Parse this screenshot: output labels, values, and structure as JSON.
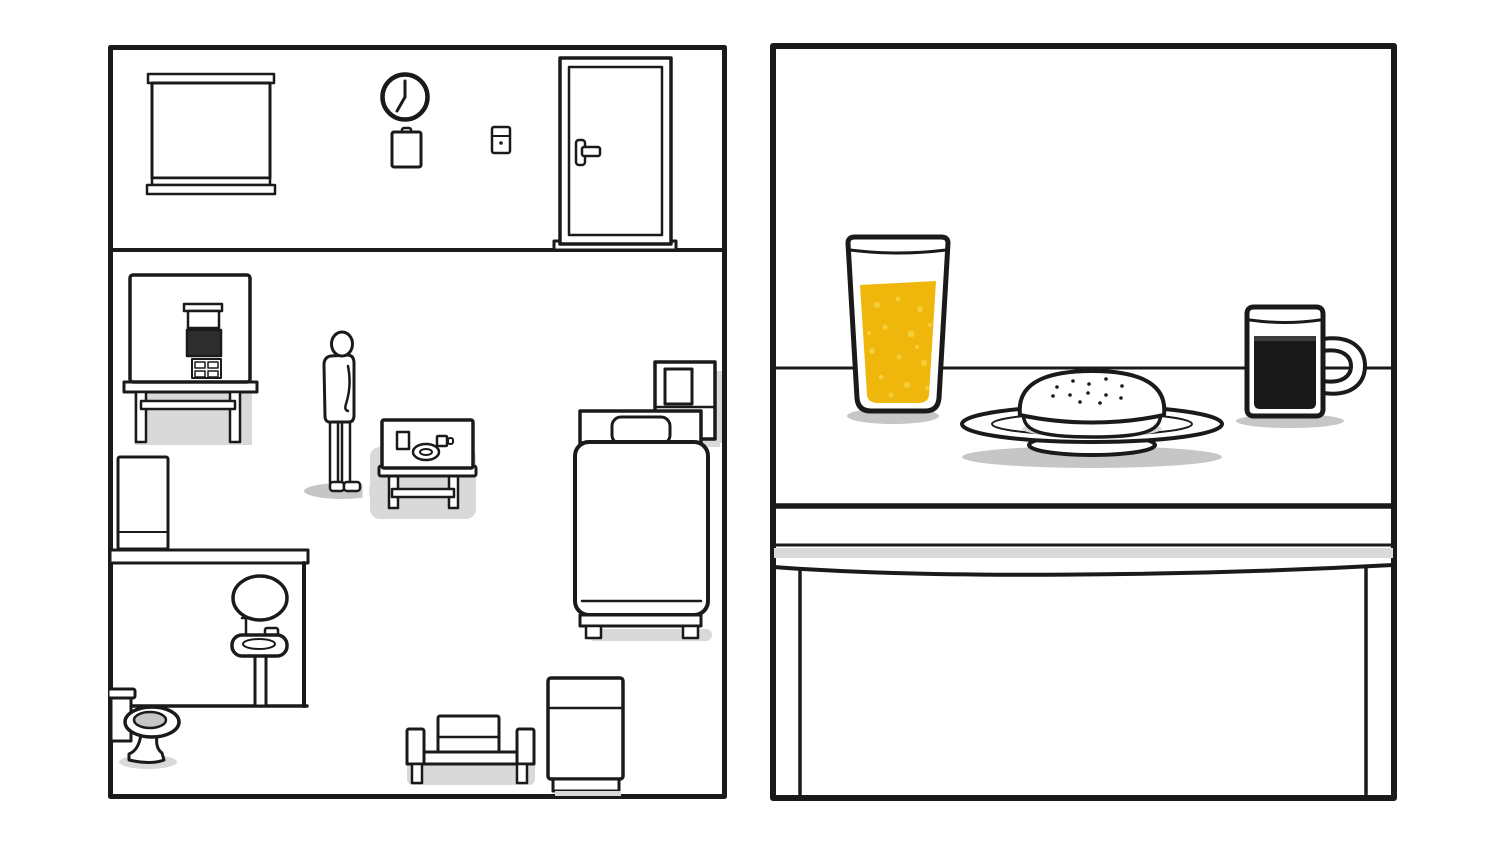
{
  "scene": {
    "game_style": "white-door-room",
    "text_content": "none"
  },
  "colors": {
    "background": "#ffffff",
    "line": "#1a1a1a",
    "juice": "#efb70b",
    "juice_bubble": "#f6ce3a",
    "coffee": "#191919",
    "coffee_surface": "#3c3c3c",
    "shadow": "#c6c6c6",
    "shadow_light": "#d9d9d9",
    "gray_strip": "#d9d9d9",
    "toilet_water": "#c6c6c6",
    "screen": "#2e2e2e",
    "glow": "#ffffff"
  },
  "clock": {
    "time": "7:00"
  },
  "left_room": {
    "label": "room overview panel",
    "objects": [
      "window-blind",
      "wall-clock",
      "clipboard",
      "light-switch",
      "door",
      "food-machine",
      "machine-table",
      "person",
      "breakfast-side-table",
      "bed",
      "nightstand-photo",
      "fridge-box",
      "bathroom-partition",
      "mirror",
      "sink",
      "toilet",
      "bench-with-box",
      "bedside-cabinet"
    ]
  },
  "right_view": {
    "label": "breakfast table close-up panel",
    "objects": [
      "juice-glass",
      "bread-plate",
      "coffee-mug",
      "table-drawer"
    ]
  },
  "highlight": {
    "target": "breakfast-side-table",
    "style": "white-glow"
  }
}
